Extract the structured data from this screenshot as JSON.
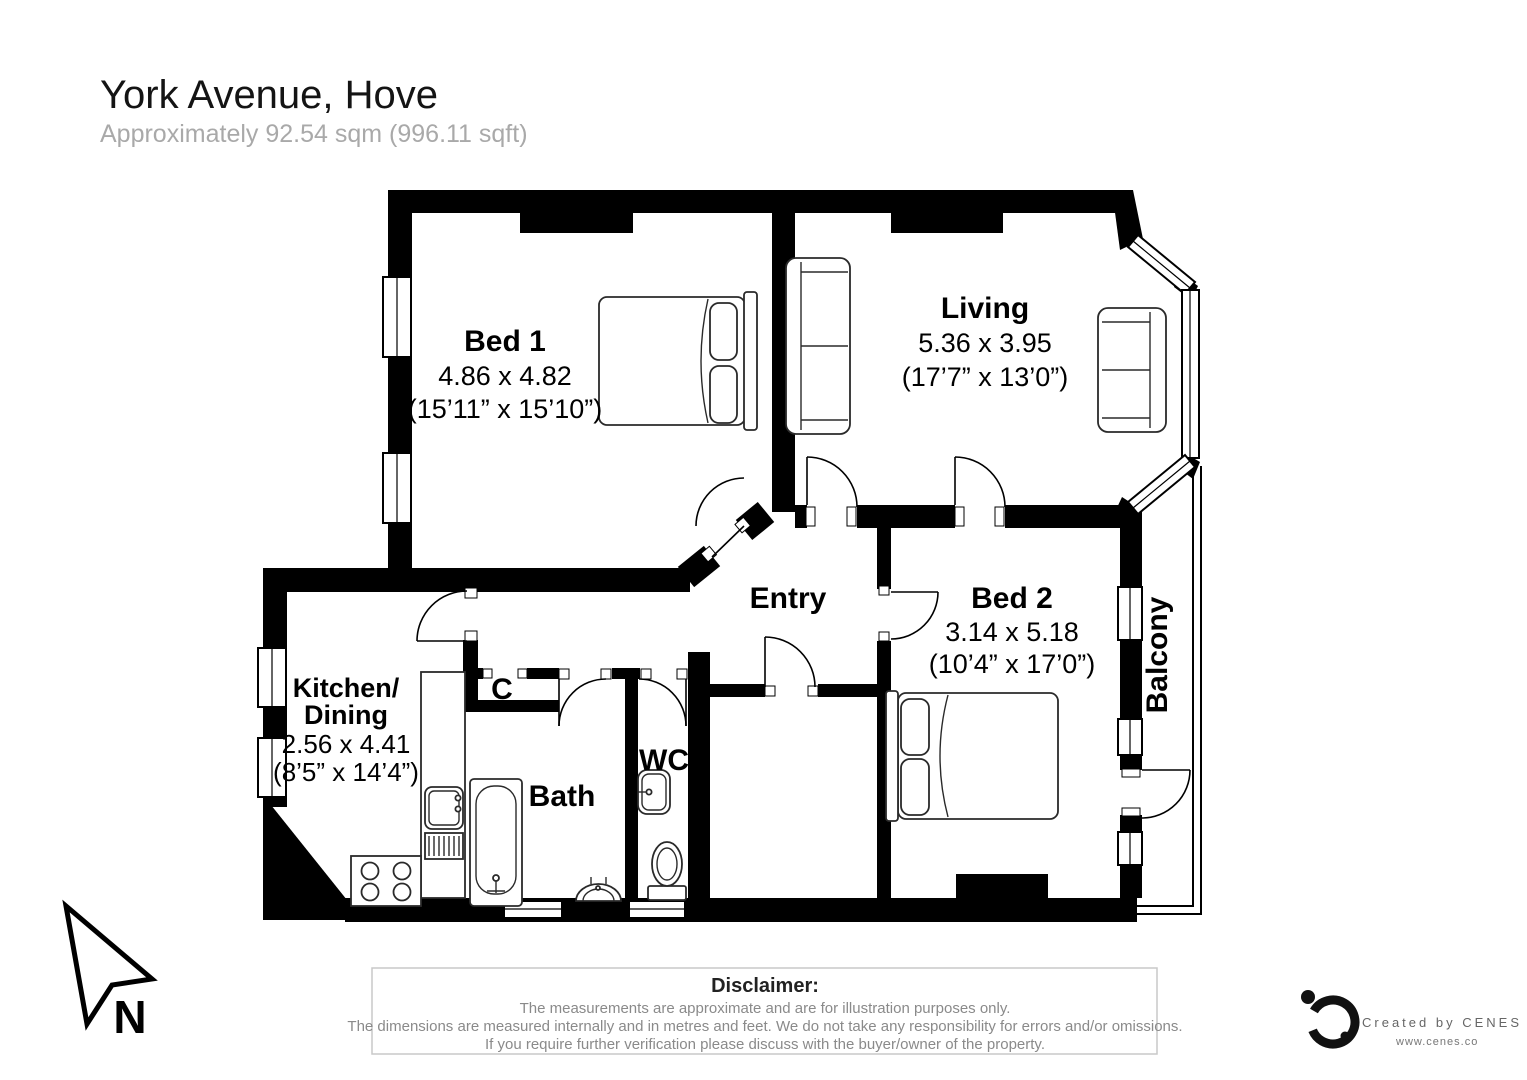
{
  "header": {
    "title": "York Avenue, Hove",
    "subtitle": "Approximately 92.54 sqm (996.11 sqft)"
  },
  "rooms": {
    "bed1": {
      "name": "Bed 1",
      "dim_m": "4.86 x 4.82",
      "dim_ft": "(15’11” x 15’10”)"
    },
    "living": {
      "name": "Living",
      "dim_m": "5.36 x 3.95",
      "dim_ft": "(17’7” x 13’0”)"
    },
    "bed2": {
      "name": "Bed 2",
      "dim_m": "3.14 x  5.18",
      "dim_ft": "(10’4” x 17’0”)"
    },
    "kitchen": {
      "name": "Kitchen/",
      "name2": "Dining",
      "dim_m": "2.56 x 4.41",
      "dim_ft": "(8’5” x 14’4”)"
    },
    "entry": {
      "name": "Entry"
    },
    "bath": {
      "name": "Bath"
    },
    "wc": {
      "name": "WC"
    },
    "closet": {
      "name": "C"
    },
    "balcony": {
      "name": "Balcony"
    }
  },
  "compass": {
    "label": "N"
  },
  "disclaimer": {
    "heading": "Disclaimer:",
    "line1": "The measurements are approximate and are for illustration purposes only.",
    "line2": "The dimensions are measured internally and in metres and feet. We do not take any responsibility for errors and/or omissions.",
    "line3": "If you require further verification please discuss with the buyer/owner of the property."
  },
  "credit": {
    "line1": "Created by CENES",
    "line2": "www.cenes.co"
  },
  "colors": {
    "wall": "#000000",
    "furniture_stroke": "#2a2a2a",
    "subtitle_gray": "#a9a9a9",
    "disclaimer_gray": "#8a8a8a"
  }
}
